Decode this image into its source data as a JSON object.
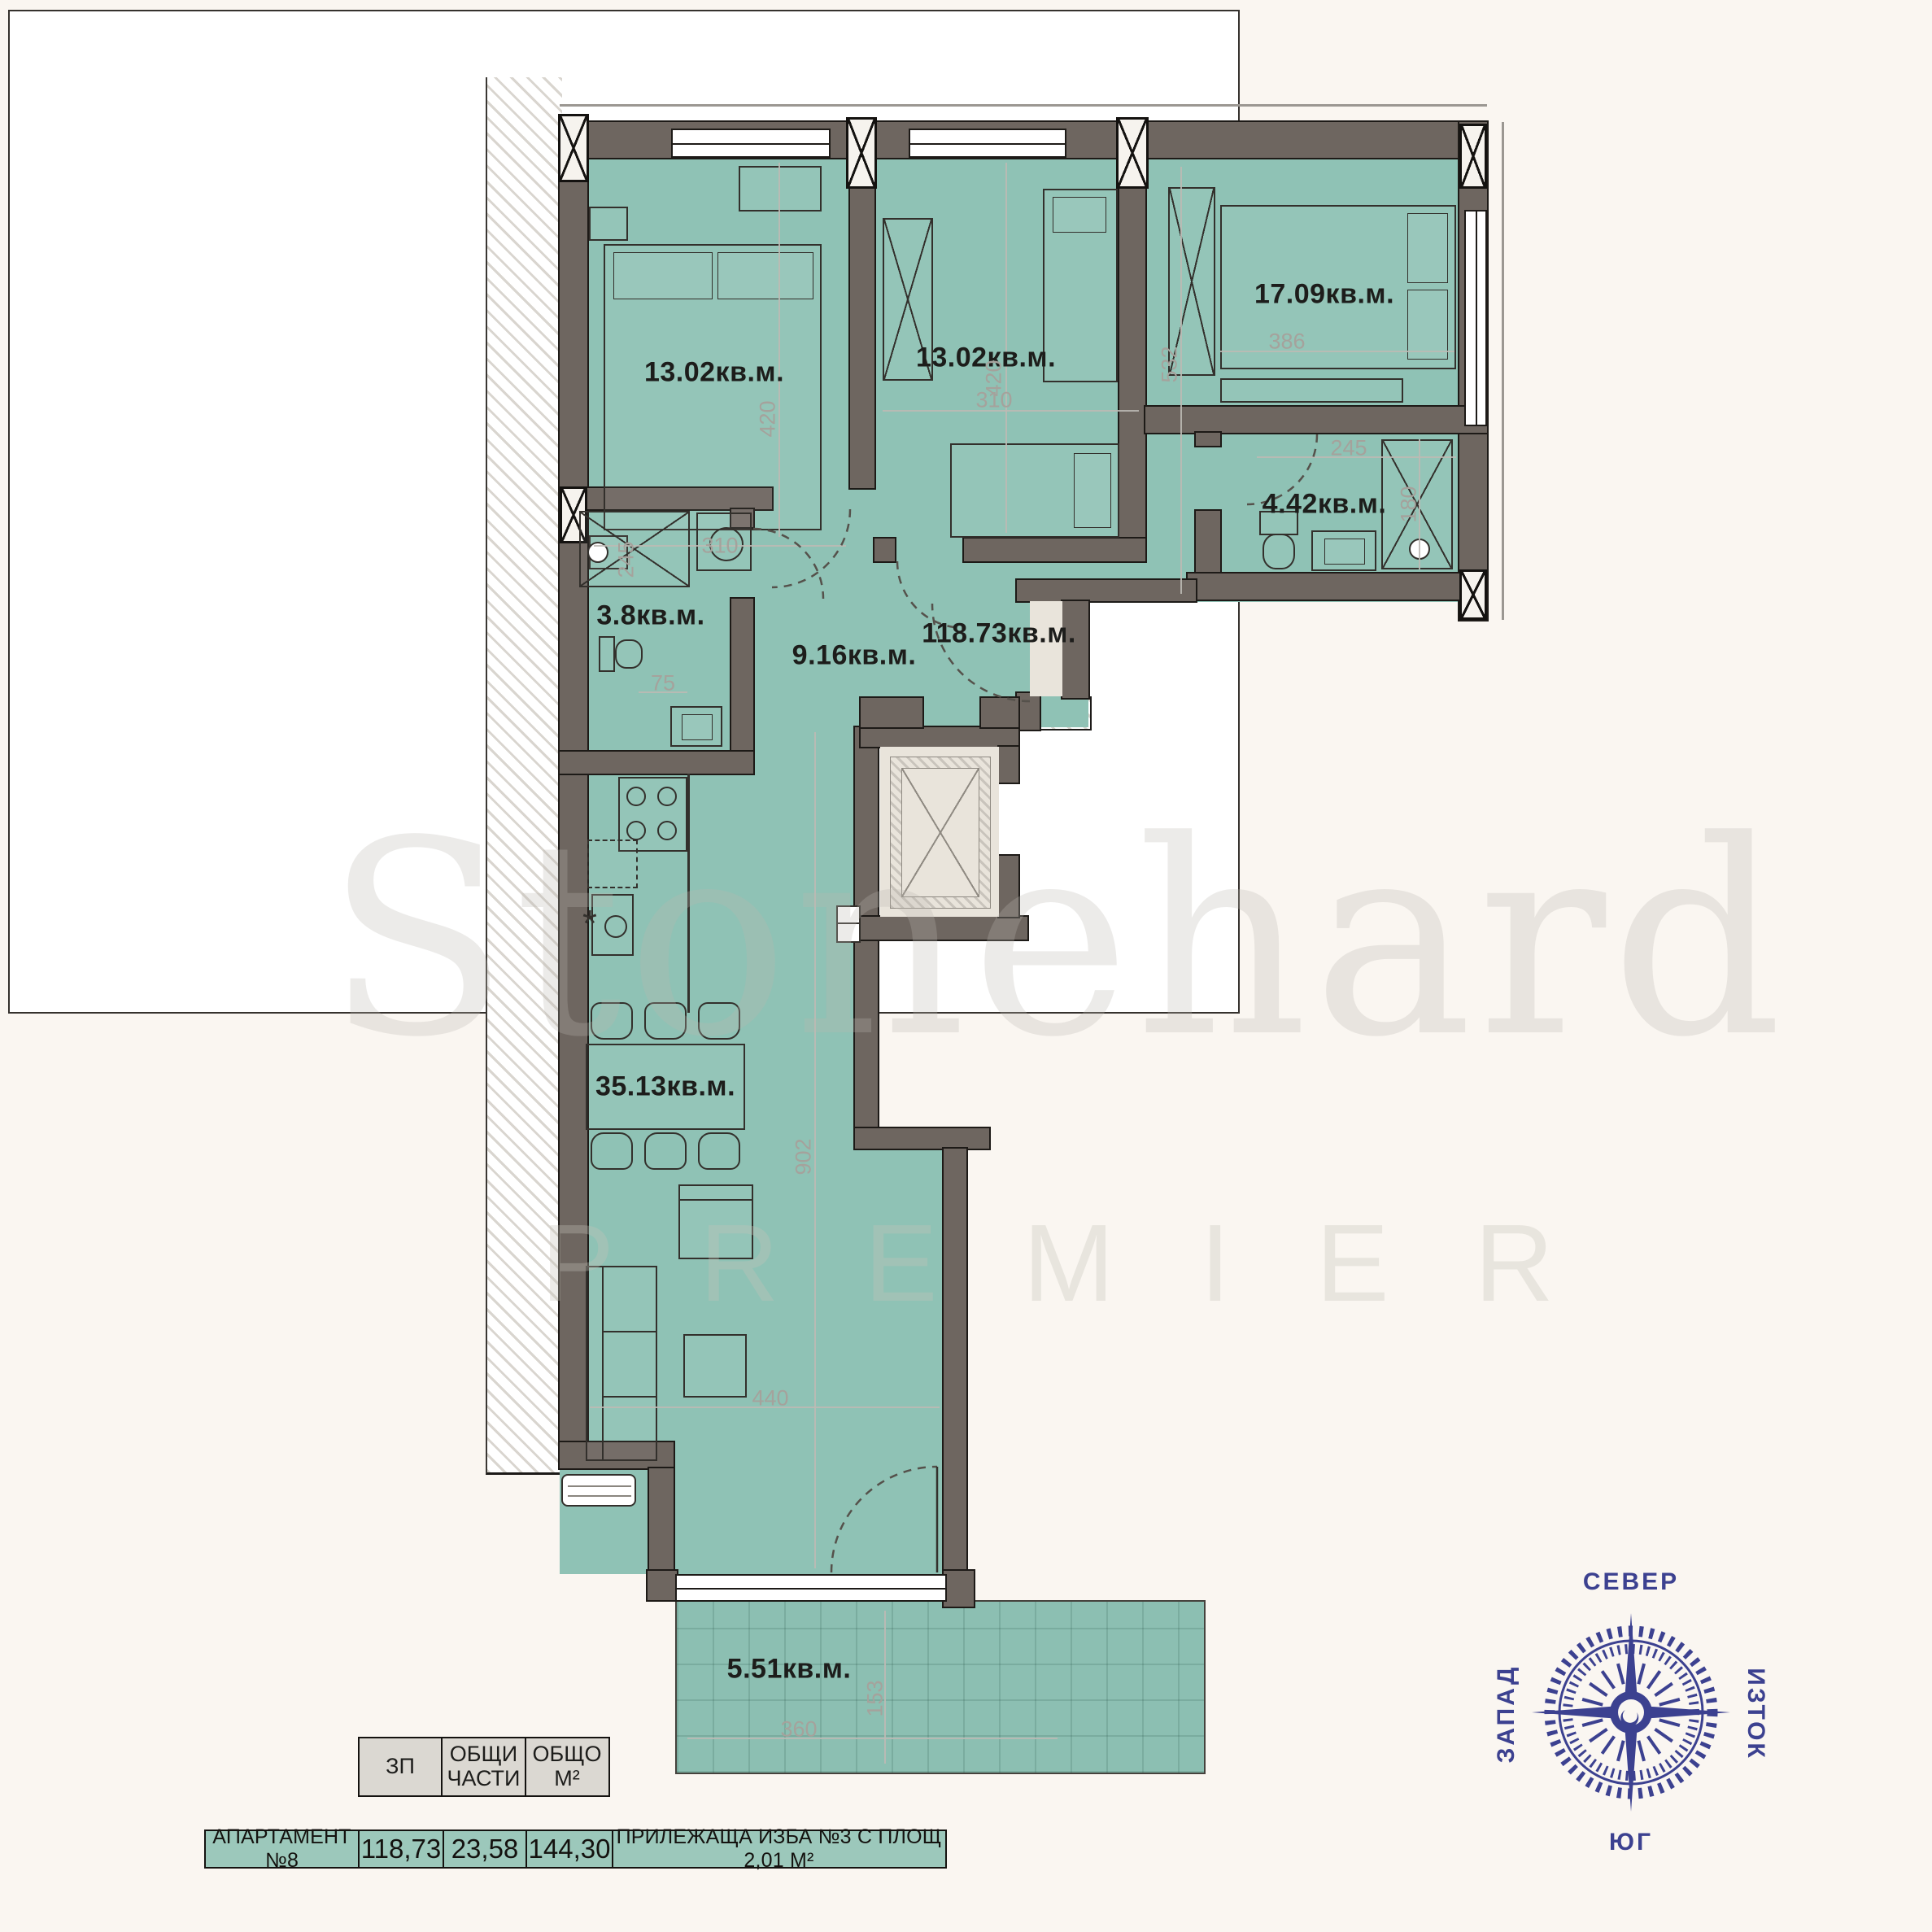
{
  "plan": {
    "room_labels": {
      "bedroom1": "13.02кв.м.",
      "bedroom2": "13.02кв.м.",
      "bedroom3": "17.09кв.м.",
      "bathroom": "4.42кв.м.",
      "laundry": "3.8кв.м.",
      "hallway": "9.16кв.м.",
      "total": "118.73кв.м.",
      "living": "35.13кв.м.",
      "terrace": "5.51кв.м."
    },
    "dimensions": {
      "bedroom1_w": "310",
      "bedroom1_h": "420",
      "bedroom2_w": "310",
      "bedroom2_h": "420",
      "bedroom3_w": "386",
      "bedroom3_h": "532",
      "bathroom_w": "245",
      "bathroom_h": "180",
      "shower": "245",
      "kitchen": "75",
      "living_h": "902",
      "living_w": "440",
      "terrace_w": "360",
      "terrace_h": "153"
    }
  },
  "watermark": {
    "brand": "Stonehard",
    "sub": "PREMIER"
  },
  "compass": {
    "north": "СЕВЕР",
    "east": "ИЗТОК",
    "south": "ЮГ",
    "west": "ЗАПАД"
  },
  "summary_table": {
    "header": [
      "ЗП",
      "ОБЩИ\nЧАСТИ",
      "ОБЩО\nМ²"
    ],
    "row": {
      "apartment": "АПАРТАМЕНТ №8",
      "zp": "118,73",
      "common": "23,58",
      "total": "144,30",
      "note": "ПРИЛЕЖАЩА ИЗБА №3 С ПЛОЩ 2,01 М²"
    }
  },
  "colors": {
    "room_fill": "#8fc2b5",
    "wall": "#6e6660",
    "accent_navy": "#3c4190",
    "paper": "#faf6f1",
    "hatch_line": "#d9d5cf"
  }
}
